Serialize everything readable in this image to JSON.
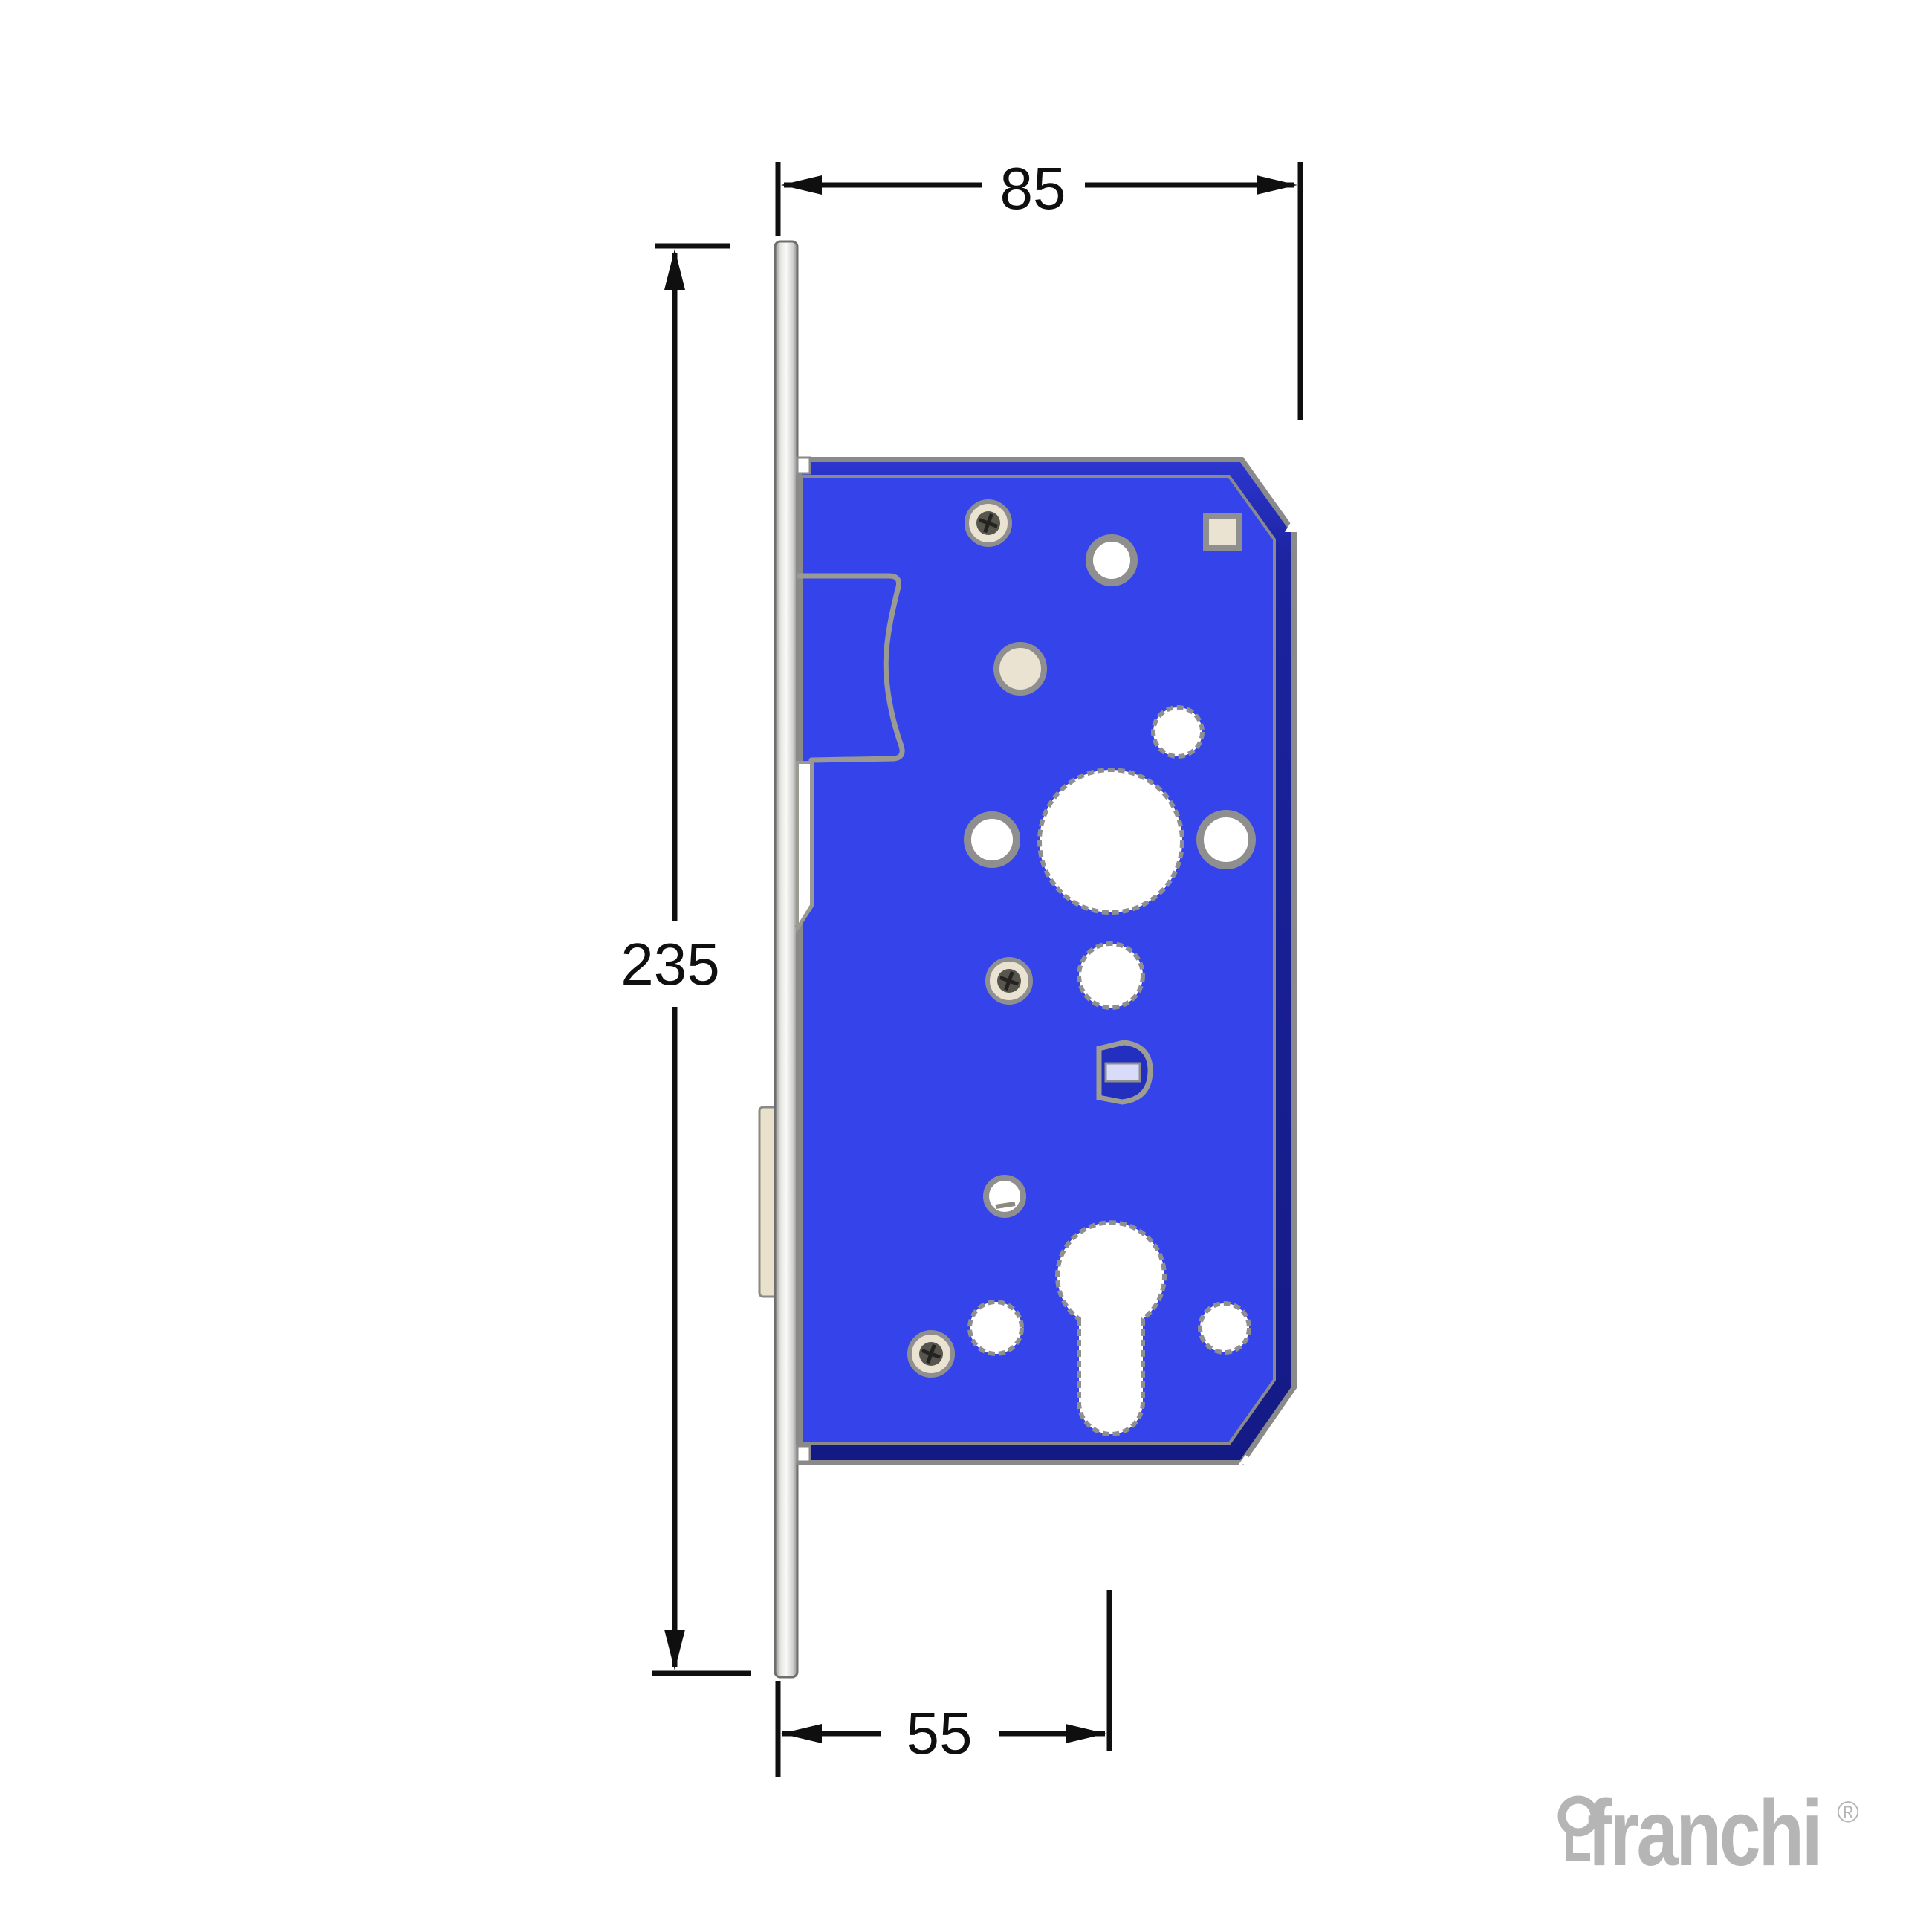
{
  "drawing": {
    "description": "mortise-lock-side-view-technical-drawing",
    "dimensions": {
      "body_depth": {
        "value": "85"
      },
      "faceplate_length": {
        "value": "235"
      },
      "backset": {
        "value": "55"
      }
    },
    "colors": {
      "body_blue": "#3544ea",
      "bevel_navy": "#1b239e",
      "outline_gray": "#8a8a8a",
      "faceplate_light": "#fafaf8",
      "cream": "#ebe3d1",
      "hole_white": "#ffffff",
      "dimension_black": "#0f0f0f",
      "logo_gray": "#b5b5b5",
      "clip_blue": "#2330bf",
      "clip_band": "#d8dcf8"
    }
  },
  "logo": {
    "brand": "franchi",
    "registered_mark": "®",
    "icon": "keyhole-icon"
  }
}
